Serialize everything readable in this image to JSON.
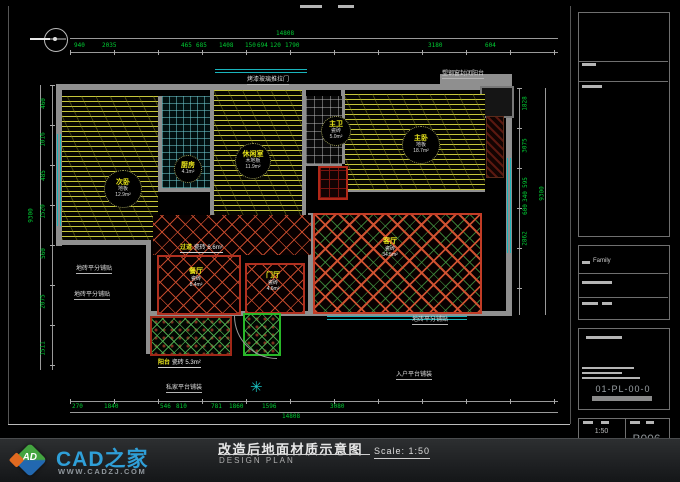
{
  "footer": {
    "brand": "CAD之家",
    "website": "WWW.CADZJ.COM",
    "cube_text": "AD",
    "title_cn": "改造后地面材质示意图",
    "title_en": "DESIGN PLAN",
    "scale_label": "Scale:  1:50"
  },
  "titleblock": {
    "family_label": "Family",
    "drawing_no": "01-PL-00-0",
    "scale": "1:50",
    "date": "2012-12-19",
    "sheet_no": "B006"
  },
  "rooms": {
    "ciwo": {
      "name": "次卧",
      "material": "地板",
      "area": "12.9m²"
    },
    "xiuxianshi": {
      "name": "休闲室",
      "material": "木地板",
      "area": "11.9m²"
    },
    "zhuwei": {
      "name": "主卫",
      "material": "瓷砖",
      "area": "5.0m²"
    },
    "zhuwo": {
      "name": "主卧",
      "material": "地板",
      "area": "18.7m²"
    },
    "chufang": {
      "name": "厨房",
      "material": "瓷砖",
      "area": "4.1m²"
    },
    "keting": {
      "name": "客厅",
      "material": "瓷砖",
      "area": "34.5m²"
    },
    "canting": {
      "name": "餐厅",
      "material": "瓷砖",
      "area": "8.4m²"
    },
    "menting": {
      "name": "门厅",
      "material": "瓷砖",
      "area": "4.6m²"
    },
    "guodao": {
      "name": "过道",
      "material": "瓷砖",
      "area": "6.6m²"
    },
    "yangtai": {
      "name": "阳台",
      "material": "瓷砖",
      "area": "5.3m²"
    }
  },
  "annotations": {
    "a1": "烤漆玻璃推拉门",
    "a2": "塑钢窗封闭阳台",
    "a3": "地砖平分铺贴",
    "a4": "地砖平分铺贴",
    "a5": "地砖平分铺贴",
    "a6": "私家平台铺装",
    "a7": "入户平台铺装"
  },
  "dims": {
    "top": [
      "940",
      "2035",
      "465",
      "685",
      "1408",
      "150",
      "694",
      "120",
      "1790",
      "3180",
      "604"
    ],
    "top_total": "14808",
    "bottom": [
      "270",
      "1840",
      "546",
      "810",
      "781",
      "1860",
      "1596",
      "3080"
    ],
    "bottom_total": "14808",
    "left": [
      "460",
      "1016",
      "485",
      "1520",
      "560",
      "2075",
      "1511"
    ],
    "left_total": "9300",
    "right": [
      "1828",
      "3075",
      "595",
      "340",
      "600",
      "2862"
    ],
    "right_total": "9300"
  }
}
